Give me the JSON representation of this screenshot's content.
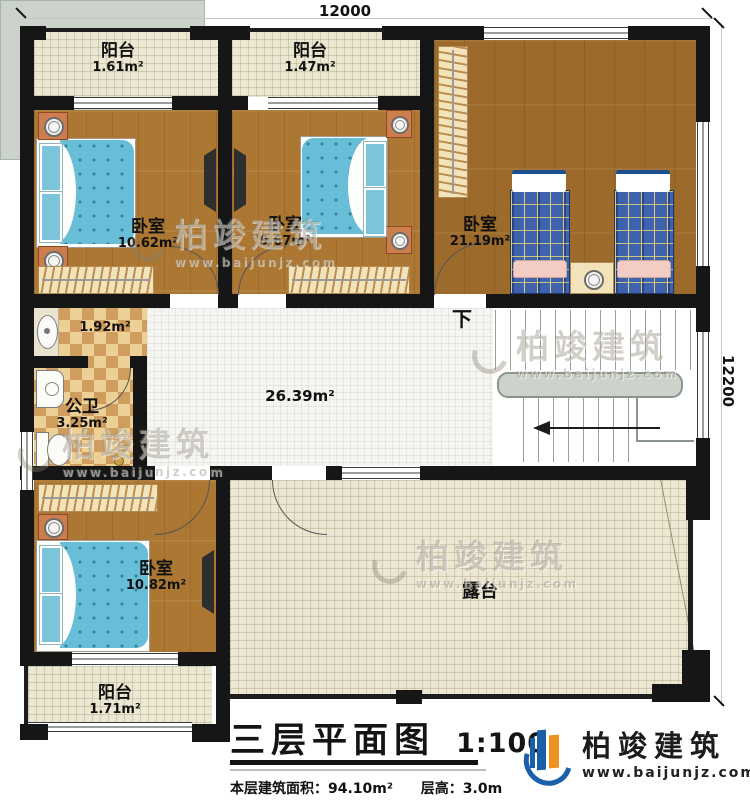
{
  "dimensions": {
    "top": "12000",
    "right": "12200"
  },
  "rooms": {
    "balcony_tl": {
      "name": "阳台",
      "area": "1.61m²"
    },
    "balcony_tm": {
      "name": "阳台",
      "area": "1.47m²"
    },
    "bedroom1": {
      "name": "卧室",
      "area": "10.62m²"
    },
    "bedroom2": {
      "name": "卧室",
      "area": "9.67m²"
    },
    "bedroom3": {
      "name": "卧室",
      "area": "21.19m²"
    },
    "vestibule": {
      "area": "1.92m²"
    },
    "bathroom": {
      "name": "公卫",
      "area": "3.25m²"
    },
    "hall": {
      "area": "26.39m²"
    },
    "stairs": {
      "label": "下"
    },
    "bedroom4": {
      "name": "卧室",
      "area": "10.82m²"
    },
    "balcony_bl": {
      "name": "阳台",
      "area": "1.71m²"
    },
    "terrace": {
      "name": "露台"
    }
  },
  "title": {
    "text": "三层平面图",
    "scale": "1:100",
    "area_label": "本层建筑面积：",
    "area_value": "94.10m²",
    "height_label": "层高：",
    "height_value": "3.0m"
  },
  "branding": {
    "company": "柏竣建筑",
    "website": "www.baijunjz.com"
  },
  "watermark": {
    "text": "柏竣建筑",
    "website": "www.baijunjz.com"
  },
  "colors": {
    "wall": "#161616",
    "wood_floor": "#ab7732",
    "wood_floor_dark": "#9c6b2b",
    "hall_tile": "#f5f5f2",
    "balcony_tile": "#ebe7d2",
    "stairs": "#ccd3cb",
    "checker_light": "#ecd096",
    "checker_dark": "#cf9e5e",
    "bed_blue": "#68bdd7",
    "plaid_blue": "#3f62ae",
    "brand_blue": "#1a5fa8",
    "brand_orange": "#f0901e"
  }
}
